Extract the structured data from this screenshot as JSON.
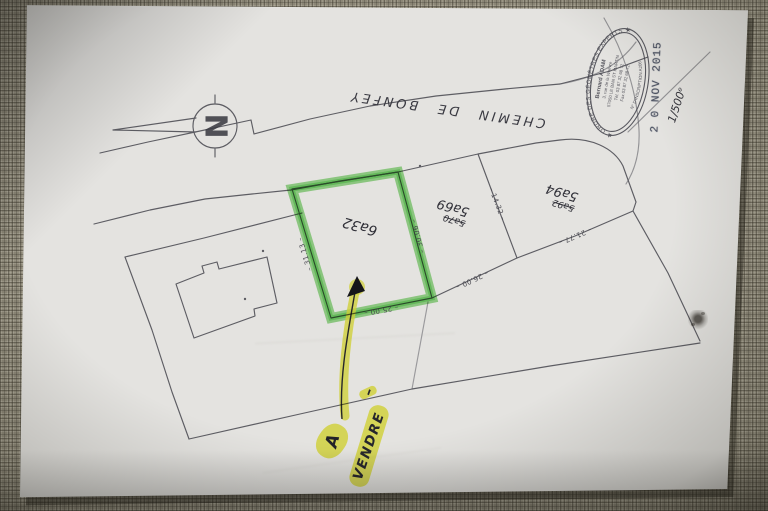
{
  "plan": {
    "street_label": "CHEMIN DE BONFEY",
    "north_letter": "N",
    "scale_note": "1/500ᵉ",
    "date_stamp": "2 0 NOV 2015",
    "sale_note": {
      "word_a": "A",
      "word_main": "VENDRE",
      "dash": "–"
    },
    "stamp": {
      "arc_top": "ORDRE DES GÉOMÈTRES EXPERTS",
      "arc_bottom": "N° D'INSCRIPTION A206",
      "star_left": "★",
      "star_right": "★",
      "lines": [
        "Bernard ADAM",
        "3, rue de la Woëvre",
        "57050 LE BAN ST MARTIN",
        "Tél. 03 87 32 68 72",
        "Fax 03 87 32 68 72"
      ]
    },
    "parcels": {
      "highlighted": {
        "area": "6a32",
        "dim_left": "– 31.13 –",
        "dim_right": "– 30.06 –",
        "dim_bottom": "– 25.00 –"
      },
      "middle": {
        "area_old": "5a70",
        "area": "5a69",
        "dim_bottom": "– 26.00 –",
        "dim_divider": "– 14.32 –"
      },
      "right": {
        "area_old": "5a92",
        "area": "5a94",
        "dim_bottom": "– 21.77 –"
      }
    },
    "colors": {
      "ink": "#46464e",
      "highlight_green": "#58c84e",
      "highlight_yellow": "#e9ea3f",
      "stamp_blue": "#3d4456",
      "paper": "#e4e3e0",
      "fabric": "#8b8676"
    }
  }
}
